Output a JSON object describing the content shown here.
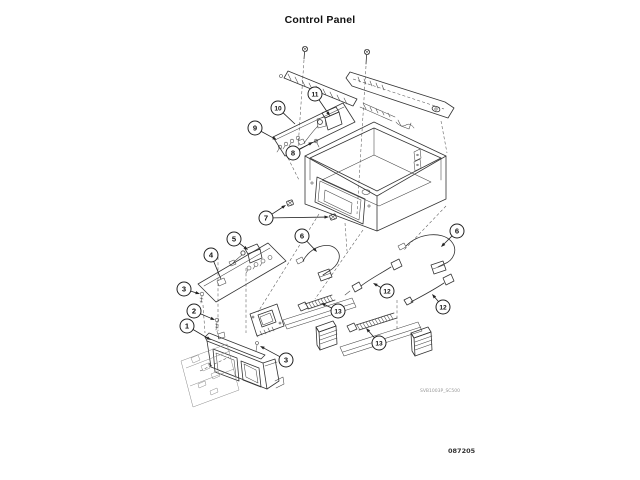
{
  "page": {
    "title": "Control Panel",
    "drawing_code": "SVB1003P_SC500",
    "figure_number": "087205"
  },
  "diagram": {
    "description": "Exploded parts diagram of a washer control panel assembly with numbered callouts",
    "callout_style": {
      "radius": 7,
      "stroke": "#222222",
      "fill": "#ffffff"
    },
    "callouts": [
      {
        "label": "1",
        "cx": 187,
        "cy": 326,
        "targets": [
          {
            "x": 211,
            "y": 340,
            "head": true
          }
        ]
      },
      {
        "label": "2",
        "cx": 194,
        "cy": 311,
        "targets": [
          {
            "x": 215,
            "y": 320,
            "head": true
          }
        ]
      },
      {
        "label": "3",
        "cx": 184,
        "cy": 289,
        "targets": [
          {
            "x": 200,
            "y": 294,
            "head": true
          }
        ]
      },
      {
        "label": "3",
        "cx": 286,
        "cy": 360,
        "targets": [
          {
            "x": 260,
            "y": 346,
            "head": true
          }
        ]
      },
      {
        "label": "4",
        "cx": 211,
        "cy": 255,
        "targets": [
          {
            "x": 221,
            "y": 279,
            "head": false
          }
        ]
      },
      {
        "label": "5",
        "cx": 234,
        "cy": 239,
        "targets": [
          {
            "x": 248,
            "y": 250,
            "head": true
          }
        ]
      },
      {
        "label": "6",
        "cx": 302,
        "cy": 236,
        "targets": [
          {
            "x": 317,
            "y": 252,
            "head": true
          }
        ]
      },
      {
        "label": "6",
        "cx": 457,
        "cy": 231,
        "targets": [
          {
            "x": 441,
            "y": 247,
            "head": true
          }
        ]
      },
      {
        "label": "7",
        "cx": 266,
        "cy": 218,
        "targets": [
          {
            "x": 286,
            "y": 205,
            "head": true
          },
          {
            "x": 329,
            "y": 217,
            "head": true
          }
        ]
      },
      {
        "label": "8",
        "cx": 293,
        "cy": 153,
        "targets": [
          {
            "x": 313,
            "y": 142,
            "head": true
          }
        ]
      },
      {
        "label": "9",
        "cx": 255,
        "cy": 128,
        "targets": [
          {
            "x": 277,
            "y": 140,
            "head": true
          }
        ]
      },
      {
        "label": "10",
        "cx": 278,
        "cy": 108,
        "targets": [
          {
            "x": 295,
            "y": 124,
            "head": false
          }
        ]
      },
      {
        "label": "11",
        "cx": 315,
        "cy": 94,
        "targets": [
          {
            "x": 330,
            "y": 116,
            "head": true
          }
        ]
      },
      {
        "label": "12",
        "cx": 387,
        "cy": 291,
        "targets": [
          {
            "x": 373,
            "y": 283,
            "head": true
          }
        ]
      },
      {
        "label": "12",
        "cx": 443,
        "cy": 307,
        "targets": [
          {
            "x": 432,
            "y": 294,
            "head": true
          }
        ]
      },
      {
        "label": "13",
        "cx": 338,
        "cy": 311,
        "targets": [
          {
            "x": 321,
            "y": 303,
            "head": true
          }
        ]
      },
      {
        "label": "13",
        "cx": 379,
        "cy": 343,
        "targets": [
          {
            "x": 366,
            "y": 328,
            "head": true
          }
        ]
      }
    ]
  }
}
